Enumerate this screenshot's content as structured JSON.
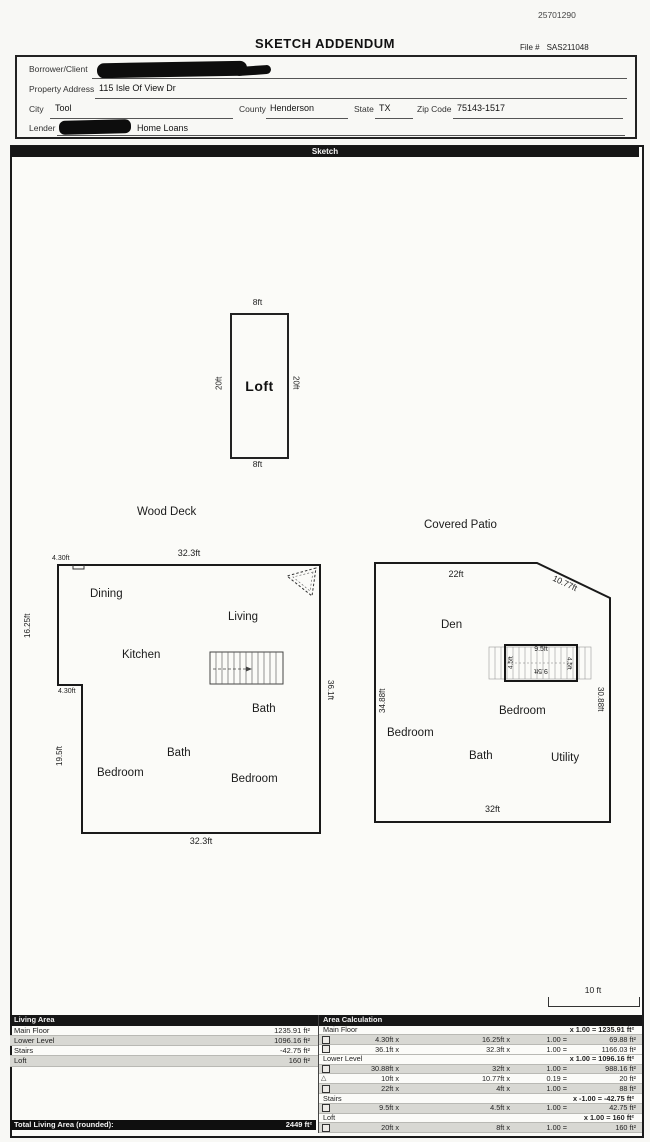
{
  "page": {
    "doc_number": "25701290",
    "title": "SKETCH ADDENDUM",
    "file_label": "File #",
    "file_number": "SAS211048"
  },
  "form": {
    "borrower_label": "Borrower/Client",
    "property_label": "Property Address",
    "property_value": "115 Isle Of View Dr",
    "city_label": "City",
    "city_value": "Tool",
    "county_label": "County",
    "county_value": "Henderson",
    "state_label": "State",
    "state_value": "TX",
    "zip_label": "Zip Code",
    "zip_value": "75143-1517",
    "lender_label": "Lender",
    "lender_value": "Home Loans"
  },
  "sketch": {
    "section_title": "Sketch",
    "scale_label": "10 ft"
  },
  "icons": {
    "triangle": "△"
  },
  "loft": {
    "name": "Loft",
    "dim_top": "8ft",
    "dim_bottom": "8ft",
    "dim_left": "20ft",
    "dim_right": "20ft"
  },
  "main_floor": {
    "deck_label": "Wood Deck",
    "dim_top": "32.3ft",
    "dim_top_notch": "4.30ft",
    "dim_left_upper": "16.25ft",
    "dim_step": "4.30ft",
    "dim_left_lower": "19.5ft",
    "dim_right": "36.1ft",
    "dim_bottom": "32.3ft",
    "rooms": {
      "dining": "Dining",
      "living": "Living",
      "kitchen": "Kitchen",
      "bath_upper": "Bath",
      "bath_lower": "Bath",
      "bedroom_left": "Bedroom",
      "bedroom_right": "Bedroom"
    }
  },
  "lower_level": {
    "patio_label": "Covered Patio",
    "dim_top": "22ft",
    "dim_diagonal": "10.77ft",
    "dim_left": "34.88ft",
    "dim_right": "30.88ft",
    "dim_bottom": "32ft",
    "rooms": {
      "den": "Den",
      "bedroom_center": "Bedroom",
      "bedroom_left": "Bedroom",
      "bath": "Bath",
      "utility": "Utility"
    },
    "stairs": {
      "dim_top": "9.5ft",
      "dim_bottom": "9.5ft",
      "dim_left": "4.5ft",
      "dim_right": "4.5ft"
    }
  },
  "living_area_table": {
    "header": "Living Area",
    "rows": [
      {
        "label": "Main Floor",
        "value": "1235.91 ft²"
      },
      {
        "label": "Lower Level",
        "value": "1096.16 ft²"
      },
      {
        "label": "Stairs",
        "value": "-42.75 ft²"
      },
      {
        "label": "Loft",
        "value": "160 ft²"
      }
    ],
    "total_label": "Total Living Area (rounded):",
    "total_value": "2449 ft²"
  },
  "area_calc_table": {
    "header": "Area Calculation",
    "rows": [
      {
        "type": "group",
        "label": "Main Floor",
        "formula": "x 1.00 = 1235.91 ft²"
      },
      {
        "type": "calc",
        "shape": "rect",
        "a": "4.30ft x",
        "b": "16.25ft x",
        "factor": "1.00 =",
        "result": "69.88 ft²"
      },
      {
        "type": "calc",
        "shape": "rect",
        "a": "36.1ft x",
        "b": "32.3ft x",
        "factor": "1.00 =",
        "result": "1166.03 ft²"
      },
      {
        "type": "group",
        "label": "Lower Level",
        "formula": "x 1.00 = 1096.16 ft²"
      },
      {
        "type": "calc",
        "shape": "rect",
        "a": "30.88ft x",
        "b": "32ft x",
        "factor": "1.00 =",
        "result": "988.16 ft²"
      },
      {
        "type": "calc",
        "shape": "triangle",
        "a": "10ft x",
        "b": "10.77ft x",
        "factor": "0.19 =",
        "result": "20 ft²"
      },
      {
        "type": "calc",
        "shape": "rect",
        "a": "22ft x",
        "b": "4ft x",
        "factor": "1.00 =",
        "result": "88 ft²"
      },
      {
        "type": "group",
        "label": "Stairs",
        "formula": "x -1.00 = -42.75 ft²"
      },
      {
        "type": "calc",
        "shape": "rect",
        "a": "9.5ft x",
        "b": "4.5ft x",
        "factor": "1.00 =",
        "result": "42.75 ft²"
      },
      {
        "type": "group",
        "label": "Loft",
        "formula": "x 1.00 = 160 ft²"
      },
      {
        "type": "calc",
        "shape": "rect",
        "a": "20ft x",
        "b": "8ft x",
        "factor": "1.00 =",
        "result": "160 ft²"
      }
    ]
  }
}
